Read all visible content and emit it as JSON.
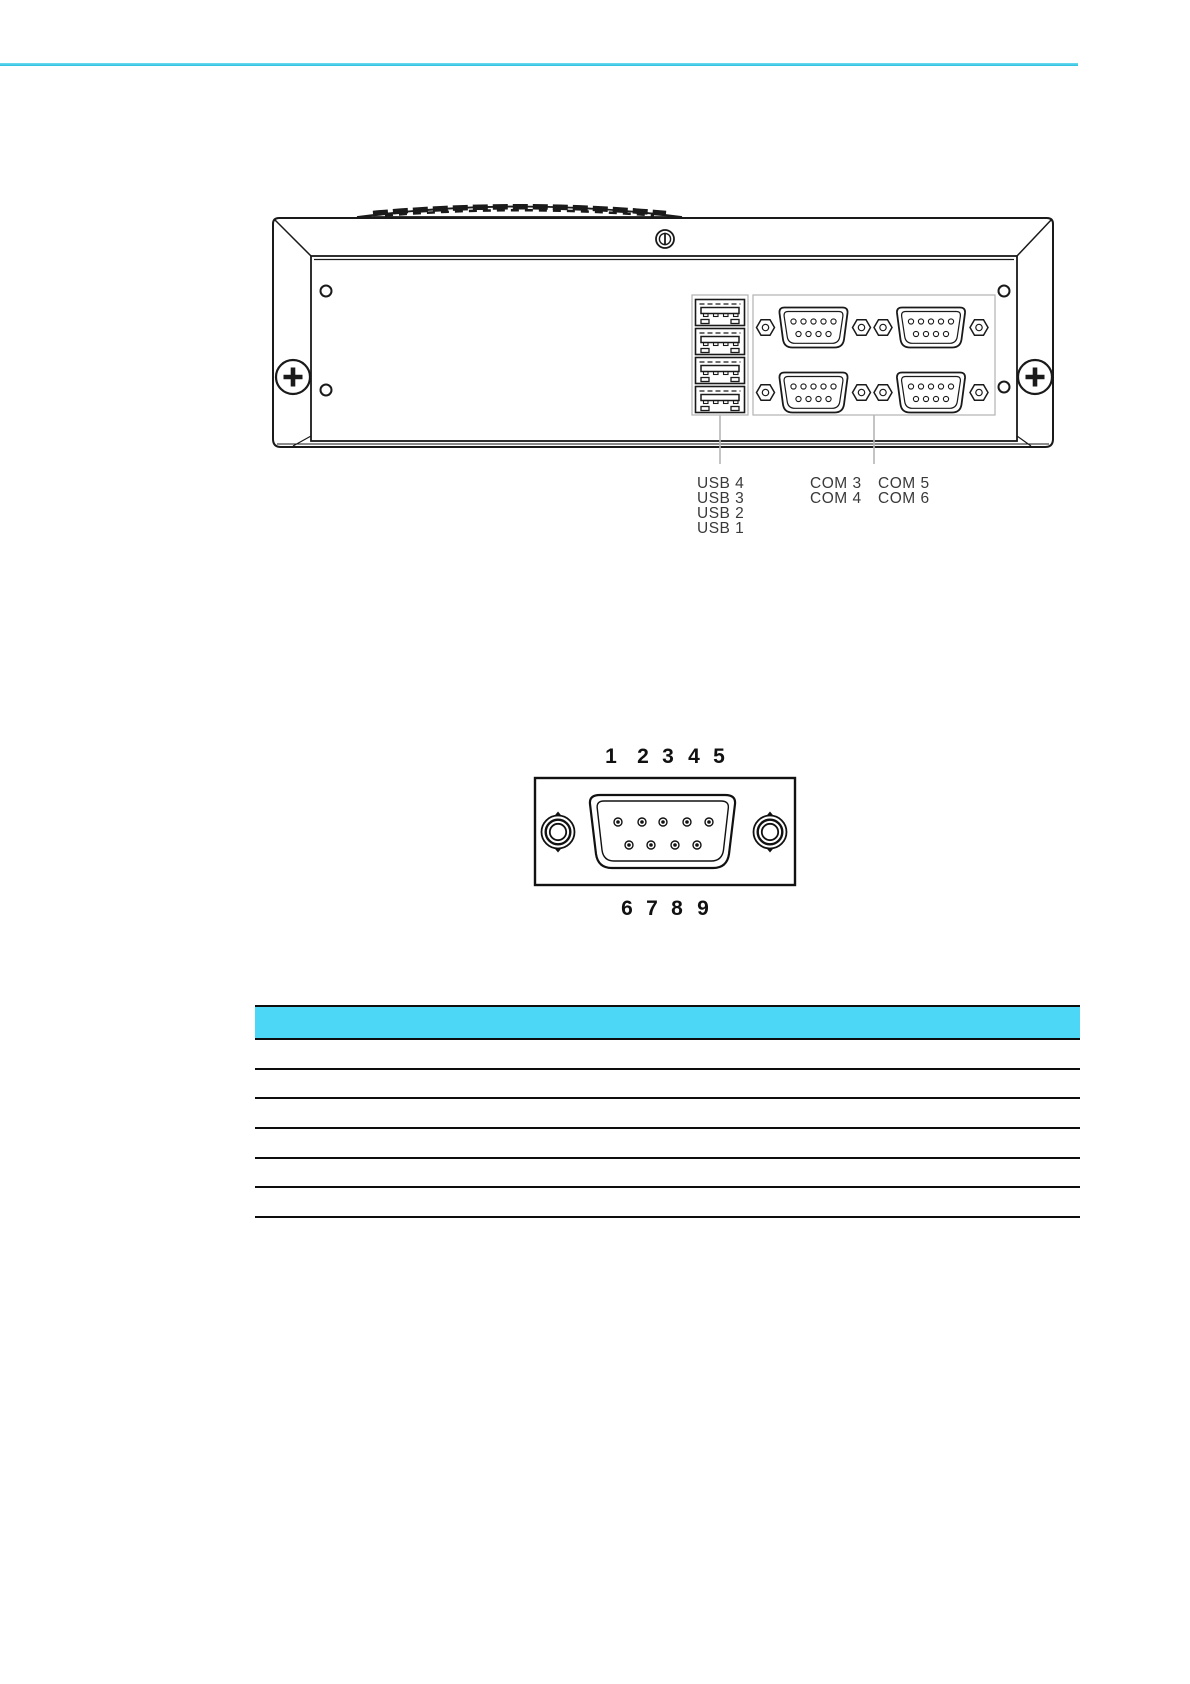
{
  "rear_panel_figure": {
    "usb_labels": [
      "USB 4",
      "USB 3",
      "USB 2",
      "USB 1"
    ],
    "com_labels_left": [
      "COM 3",
      "COM 4"
    ],
    "com_labels_right": [
      "COM 5",
      "COM 6"
    ]
  },
  "connector_figure": {
    "top_pin_numbers": [
      "1",
      "2",
      "3",
      "4",
      "5"
    ],
    "bottom_pin_numbers": [
      "6",
      "7",
      "8",
      "9"
    ]
  },
  "pin_table": {
    "row_count": 6
  },
  "colors": {
    "top_rule_cyan": "#2fc3e2",
    "table_header_cyan": "#4dd7f7",
    "line_art": "#1a1a1a"
  }
}
